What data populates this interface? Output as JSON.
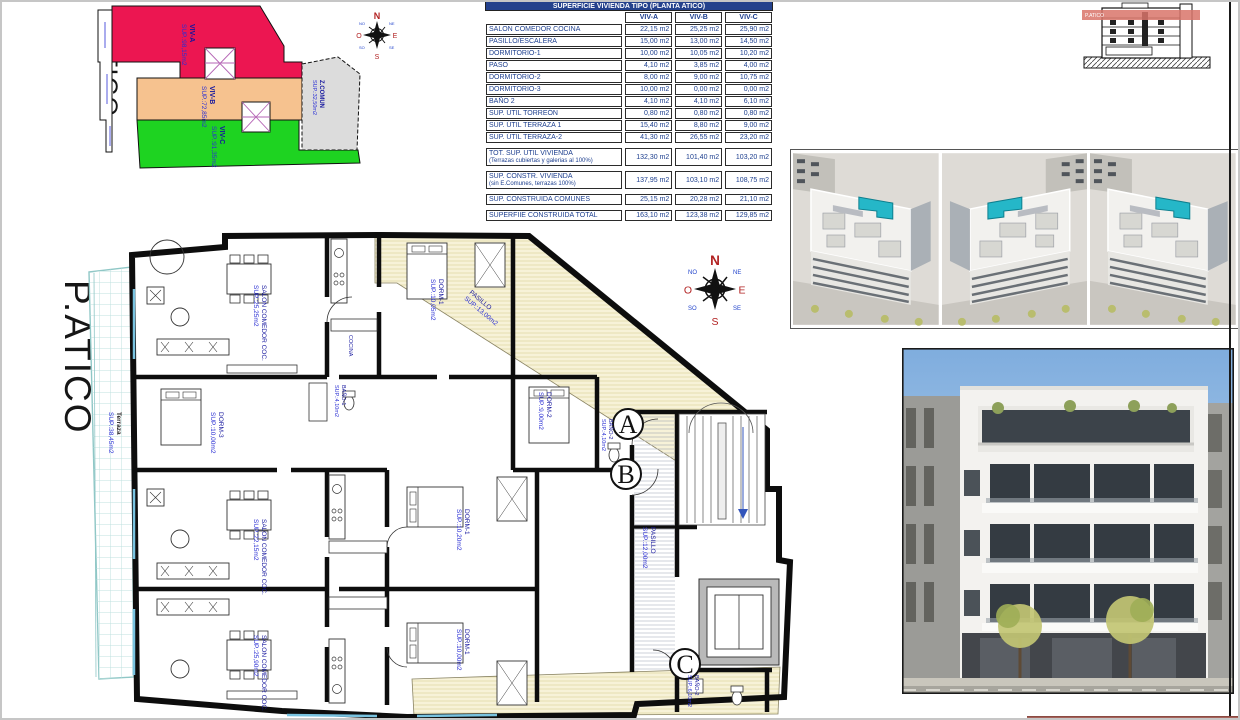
{
  "site_plan": {
    "title": "P.ATICO",
    "zones": [
      {
        "name": "VIV-A",
        "sup": "SUP.:98,15m2",
        "color": "#ec1651"
      },
      {
        "name": "VIV-B",
        "sup": "SUP.:72,85m2",
        "color": "#f6c28f"
      },
      {
        "name": "VIV-C",
        "sup": "SUP.:91,35m2",
        "color": "#1ed321"
      },
      {
        "name": "Z.COMUN",
        "sup": "SUP.:32,50m2",
        "color": "#dcdcdc"
      }
    ]
  },
  "compass": {
    "n": "N",
    "e": "E",
    "s": "S",
    "o": "O",
    "inter": [
      "NE",
      "SE",
      "SO",
      "NO"
    ]
  },
  "area_table": {
    "title": "SUPERFICIE VIVIENDA TIPO (PLANTA ATICO)",
    "columns": [
      "VIV-A",
      "VIV-B",
      "VIV-C"
    ],
    "rows": [
      {
        "label": "SALON COMEDOR COCINA",
        "a": "22,15 m2",
        "b": "25,25 m2",
        "c": "25,90 m2"
      },
      {
        "label": "PASILLO/ESCALERA",
        "a": "15,00 m2",
        "b": "13,00 m2",
        "c": "14,50 m2"
      },
      {
        "label": "DORMITORIO-1",
        "a": "10,00 m2",
        "b": "10,05 m2",
        "c": "10,20 m2"
      },
      {
        "label": "PASO",
        "a": "4,10 m2",
        "b": "3,85 m2",
        "c": "4,00 m2"
      },
      {
        "label": "DORMITORIO-2",
        "a": "8,00 m2",
        "b": "9,00 m2",
        "c": "10,75 m2"
      },
      {
        "label": "DORMITORIO-3",
        "a": "10,00 m2",
        "b": "0,00 m2",
        "c": "0,00 m2"
      },
      {
        "label": "BAÑO 2",
        "a": "4,10 m2",
        "b": "4,10 m2",
        "c": "6,10 m2"
      },
      {
        "label": "SUP. ÚTIL TORREÓN",
        "a": "0,80 m2",
        "b": "0,80 m2",
        "c": "0,80 m2"
      },
      {
        "label": "SUP. ÚTIL TERRAZA 1",
        "a": "15,40 m2",
        "b": "8,80 m2",
        "c": "9,00 m2"
      },
      {
        "label": "SUP. ÚTIL TERRAZA-2",
        "a": "41,30 m2",
        "b": "26,55 m2",
        "c": "23,20 m2"
      }
    ],
    "summary": [
      {
        "label": "TOT. SUP. UTIL VIVIENDA",
        "sub": "(Terrazas cubiertas y galerias al 100%)",
        "a": "132,30 m2",
        "b": "101,40 m2",
        "c": "103,20 m2"
      },
      {
        "label": "SUP. CONSTR. VIVIENDA",
        "sub": "(sin E.Comunes, terrazas 100%)",
        "a": "137,95 m2",
        "b": "103,10 m2",
        "c": "108,75 m2"
      },
      {
        "label": "SUP. CONSTRUIDA COMUNES",
        "sub": "",
        "a": "25,15 m2",
        "b": "20,28 m2",
        "c": "21,10 m2"
      },
      {
        "label": "SUPERFIIE CONSTRUIDA TOTAL",
        "sub": "",
        "a": "163,10 m2",
        "b": "123,38 m2",
        "c": "129,85 m2"
      }
    ]
  },
  "section_drawing": {
    "band_label": "P.ATICO"
  },
  "floor_plan": {
    "title": "P.ATICO",
    "entries": [
      "A",
      "B",
      "C"
    ],
    "rooms": [
      {
        "name": "Terraza",
        "sup": "SUP.:38,45m2"
      },
      {
        "name": "SALON COMEDOR COC.",
        "sup": "SUP.:25,25m2"
      },
      {
        "name": "DORM-1",
        "sup": "SUP.:10,05m2"
      },
      {
        "name": "PASILLO",
        "sup": "SUP.:13,00m2"
      },
      {
        "name": "DORM-2",
        "sup": "SUP.:9,00m2"
      },
      {
        "name": "BAÑO-2",
        "sup": "SUP.:4,10m2"
      },
      {
        "name": "DORM-3",
        "sup": "SUP.:10,00m2"
      },
      {
        "name": "BAÑO-1",
        "sup": "SUP.:4,10m2"
      },
      {
        "name": "SALON COMEDOR COC.",
        "sup": "SUP.:22,15m2"
      },
      {
        "name": "DORM-1",
        "sup": "SUP.:10,20m2"
      },
      {
        "name": "SALON COMEDOR COC.",
        "sup": "SUP.:25,90m2"
      },
      {
        "name": "DORM-1",
        "sup": "SUP.:10,00m2"
      },
      {
        "name": "PASILLO",
        "sup": "SUP.:12,00m2"
      },
      {
        "name": "BAÑO-2",
        "sup": "SUP.:6,10m2"
      },
      {
        "name": "COCINA",
        "sup": ""
      }
    ]
  },
  "colors": {
    "table_header_bg": "#24418c",
    "label_blue": "#2a2fd4",
    "summary_brown": "#b05224",
    "pool_teal": "#25b7c8",
    "terrace_cream": "#f7f2d8",
    "tile_cyan": "#bfe0df"
  }
}
